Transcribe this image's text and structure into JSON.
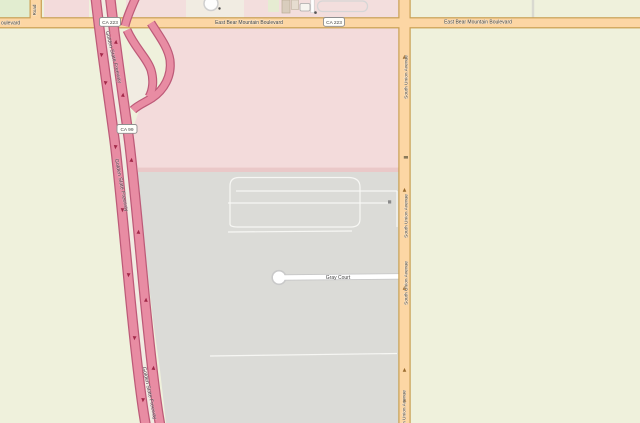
{
  "map": {
    "type": "openstreetmap-style slippy map tile view",
    "roads": {
      "boulevard": "East Bear Mountain Boulevard",
      "boulevard_partial": "oulevard",
      "freeway": "Golden State Freeway",
      "avenue": "South Union Avenue",
      "court": "Gray Court",
      "left_road": "Road",
      "shield_223": "CA 223",
      "shield_99": "CA 99"
    },
    "colors": {
      "farmland_bg": "#eff1dc",
      "green_patch": "#e2edd0",
      "industrial_pink": "#f3dbdb",
      "pink_edge_strip": "#eac8c8",
      "quarry_gray": "#dbdbd7",
      "motorway_fill": "#e88ca3",
      "motorway_casing": "#bd5a78",
      "primary_fill": "#fcd6a4",
      "primary_casing": "#c9a053",
      "minor_road_fill": "#ffffff",
      "minor_road_casing": "#c9c9c9",
      "label_text": "#3c3c38",
      "oneway_arrow_motorway": "#a12848",
      "oneway_arrow_primary": "#9a6b2f"
    }
  }
}
